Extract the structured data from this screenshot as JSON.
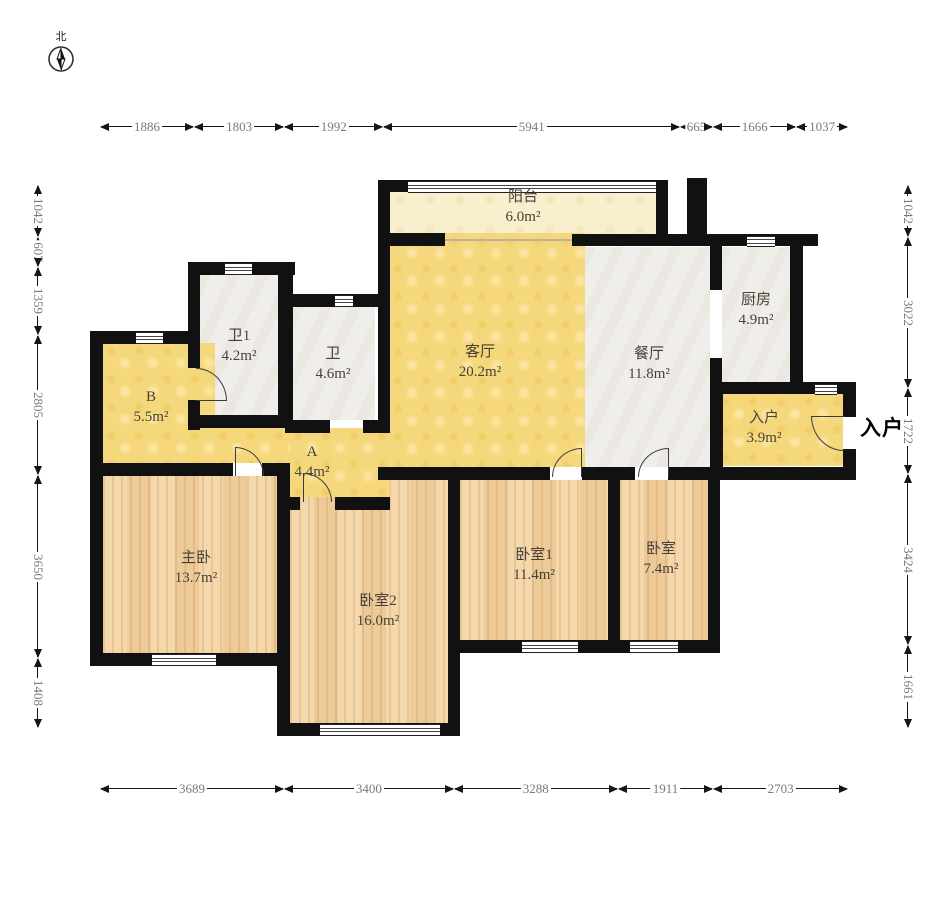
{
  "compass": {
    "north_label": "北"
  },
  "entry_marker": "入户",
  "rooms": {
    "balcony": {
      "name": "阳台",
      "area": "6.0m²"
    },
    "living": {
      "name": "客厅",
      "area": "20.2m²"
    },
    "dining": {
      "name": "餐厅",
      "area": "11.8m²"
    },
    "kitchen": {
      "name": "厨房",
      "area": "4.9m²"
    },
    "entry": {
      "name": "入户",
      "area": "3.9m²"
    },
    "bath1": {
      "name": "卫1",
      "area": "4.2m²"
    },
    "bath": {
      "name": "卫",
      "area": "4.6m²"
    },
    "roomB": {
      "name": "B",
      "area": "5.5m²"
    },
    "corridorA": {
      "name": "A",
      "area": "4.4m²"
    },
    "master": {
      "name": "主卧",
      "area": "13.7m²"
    },
    "bed2": {
      "name": "卧室2",
      "area": "16.0m²"
    },
    "bed1": {
      "name": "卧室1",
      "area": "11.4m²"
    },
    "bed3": {
      "name": "卧室",
      "area": "7.4m²"
    }
  },
  "dims": {
    "top": [
      1886,
      1803,
      1992,
      5941,
      665,
      1666,
      1037
    ],
    "bottom": [
      3689,
      3400,
      3288,
      1911,
      2703
    ],
    "left": [
      1042,
      607,
      1359,
      2805,
      3650,
      1408
    ],
    "right": [
      1042,
      3022,
      1722,
      3424,
      1661
    ]
  },
  "colors": {
    "wall": "#111111",
    "yellow_floor": "#f6d87c",
    "balcony_floor": "#f8efce",
    "tile_floor": "#f0eeea",
    "wood_floor": "#f0cf9e",
    "dim_text": "#7a7a7a"
  }
}
